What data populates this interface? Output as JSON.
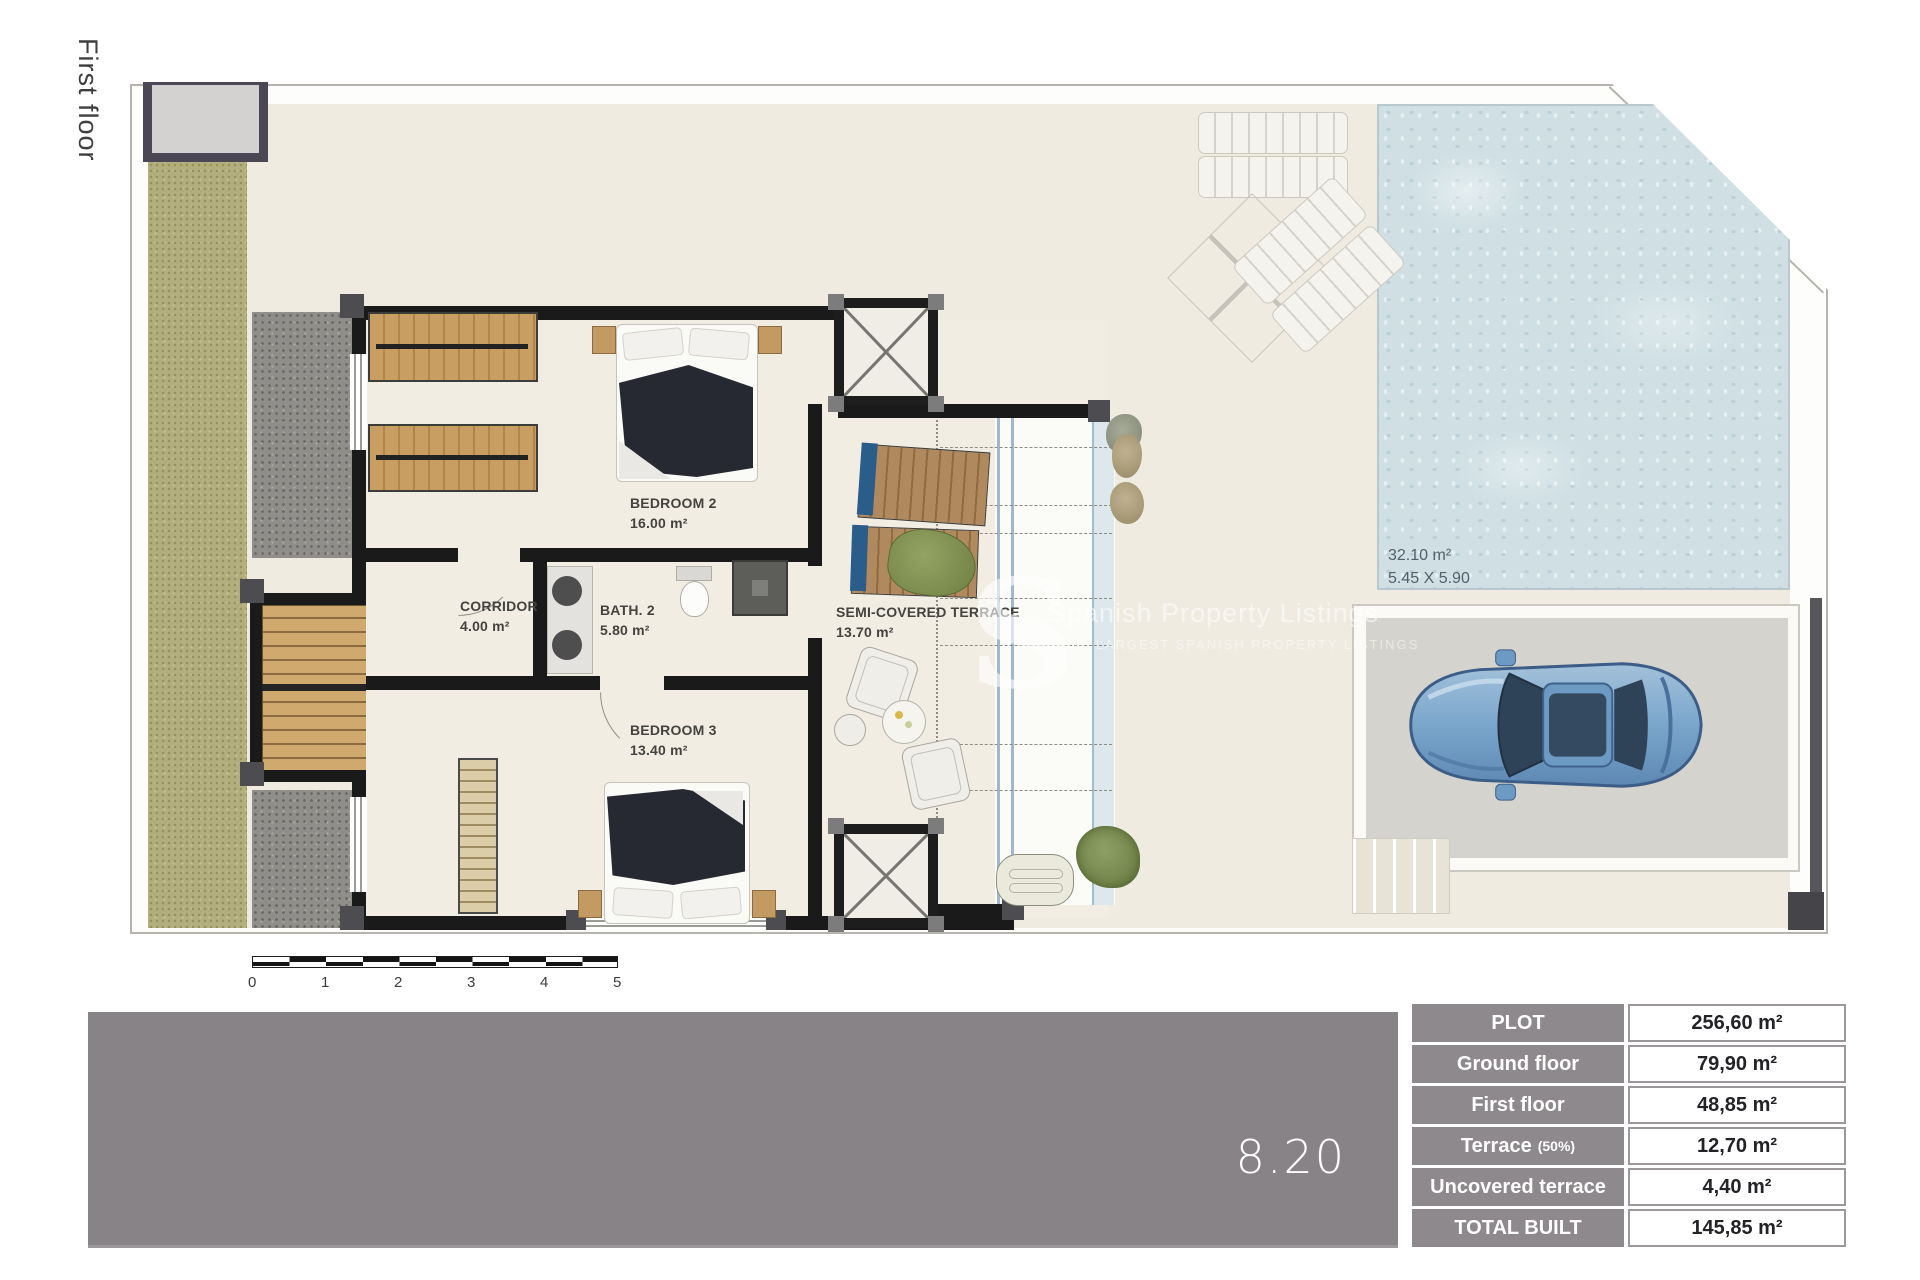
{
  "page": {
    "title_vertical": "First floor"
  },
  "plan": {
    "rooms": [
      {
        "name": "BEDROOM 2",
        "area": "16.00 m²"
      },
      {
        "name": "CORRIDOR",
        "area": "4.00 m²"
      },
      {
        "name": "BATH. 2",
        "area": "5.80 m²"
      },
      {
        "name": "BEDROOM 3",
        "area": "13.40 m²"
      },
      {
        "name": "SEMI-COVERED TERRACE",
        "area": "13.70 m²"
      }
    ],
    "pool": {
      "area": "32.10 m²",
      "dimensions": "5.45 X 5.90"
    },
    "scale_ticks": [
      "0",
      "1",
      "2",
      "3",
      "4",
      "5"
    ]
  },
  "watermark": {
    "initial": "S",
    "line1": "Spanish Property Listings",
    "line2": "THE LARGEST SPANISH PROPERTY LISTINGS"
  },
  "footer": {
    "plan_number": "8.20"
  },
  "areas_table": {
    "rows": [
      {
        "label": "PLOT",
        "value": "256,60 m²"
      },
      {
        "label": "Ground floor",
        "value": "79,90 m²"
      },
      {
        "label": "First floor",
        "value": "48,85 m²"
      },
      {
        "label": "Terrace",
        "label_suffix": "(50%)",
        "value": "12,70 m²"
      },
      {
        "label": "Uncovered terrace",
        "value": "4,40 m²"
      },
      {
        "label": "TOTAL BUILT",
        "value": "145,85 m²"
      }
    ]
  },
  "colors": {
    "wall": "#1a1a1a",
    "plot_ground": "#efebe1",
    "pool_water": "#cfdfe4",
    "lawn": "#b2ae7d",
    "gravel": "#8f8e8a",
    "footer_bar": "#878386",
    "table_header": "#8d898c",
    "car_body": "#7aa6cc"
  }
}
